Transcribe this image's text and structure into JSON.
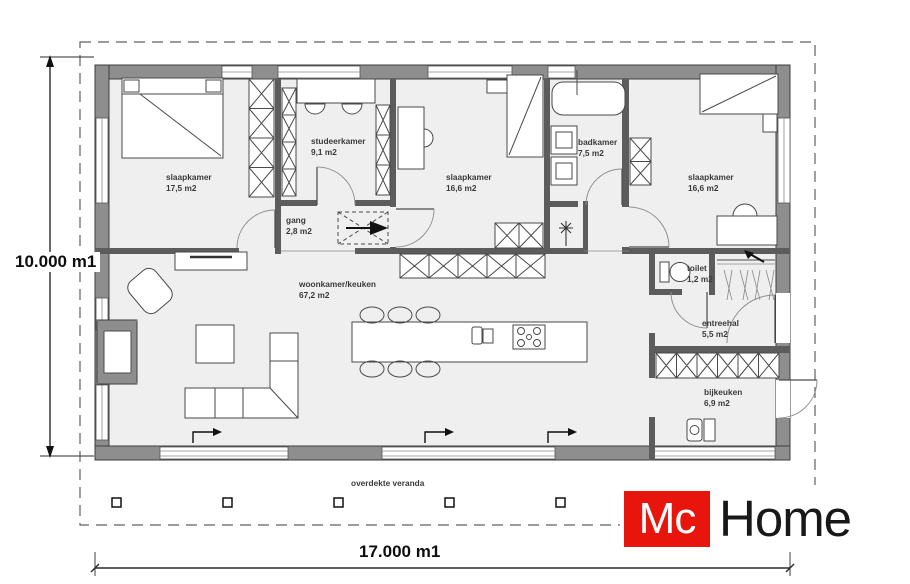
{
  "plan": {
    "rooms": [
      {
        "name": "slaapkamer",
        "area": "17,5 m2"
      },
      {
        "name": "studeerkamer",
        "area": "9,1 m2"
      },
      {
        "name": "gang",
        "area": "2,8 m2"
      },
      {
        "name": "slaapkamer",
        "area": "16,6 m2"
      },
      {
        "name": "badkamer",
        "area": "7,5 m2"
      },
      {
        "name": "slaapkamer",
        "area": "16,6 m2"
      },
      {
        "name": "woonkamer/keuken",
        "area": "67,2 m2"
      },
      {
        "name": "toilet",
        "area": "1,2 m2"
      },
      {
        "name": "entreehal",
        "area": "5,5 m2"
      },
      {
        "name": "bijkeuken",
        "area": "6,9 m2"
      }
    ],
    "veranda_label": "overdekte veranda",
    "dimensions": {
      "height_label": "10.000 m1",
      "width_label": "17.000 m1"
    }
  },
  "logo": {
    "mc": "Mc",
    "home": "Home",
    "mark_style": "background:#e8150c"
  },
  "colors": {
    "logo_red": "#e8150c",
    "wall_gray": "#8e8e8e",
    "floor_gray": "#efeff0"
  }
}
